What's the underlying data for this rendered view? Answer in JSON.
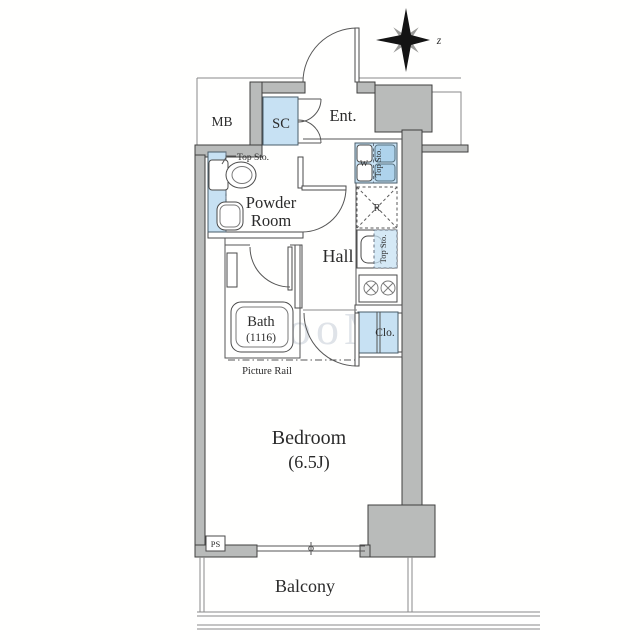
{
  "plan": {
    "compass": {
      "north_label": "z"
    },
    "watermark": "ooM",
    "labels": {
      "mb": "MB",
      "sc": "SC",
      "entrance": "Ent.",
      "powder_room_line1": "Powder",
      "powder_room_line2": "Room",
      "hall": "Hall",
      "bath_name": "Bath",
      "bath_size": "(1116)",
      "bedroom_name": "Bedroom",
      "bedroom_size": "(6.5J)",
      "balcony": "Balcony",
      "closet": "Clo.",
      "pipe_space": "PS",
      "washer": "W",
      "refrigerator": "R",
      "top_storage": "Top Sto.",
      "picture_rail": "Picture Rail"
    },
    "colors": {
      "wall_fill": "#b9bbba",
      "fixture_blue": "#c7e1f3",
      "fixture_blue_dark": "#aed3ec",
      "line": "#3f3f3f"
    }
  }
}
